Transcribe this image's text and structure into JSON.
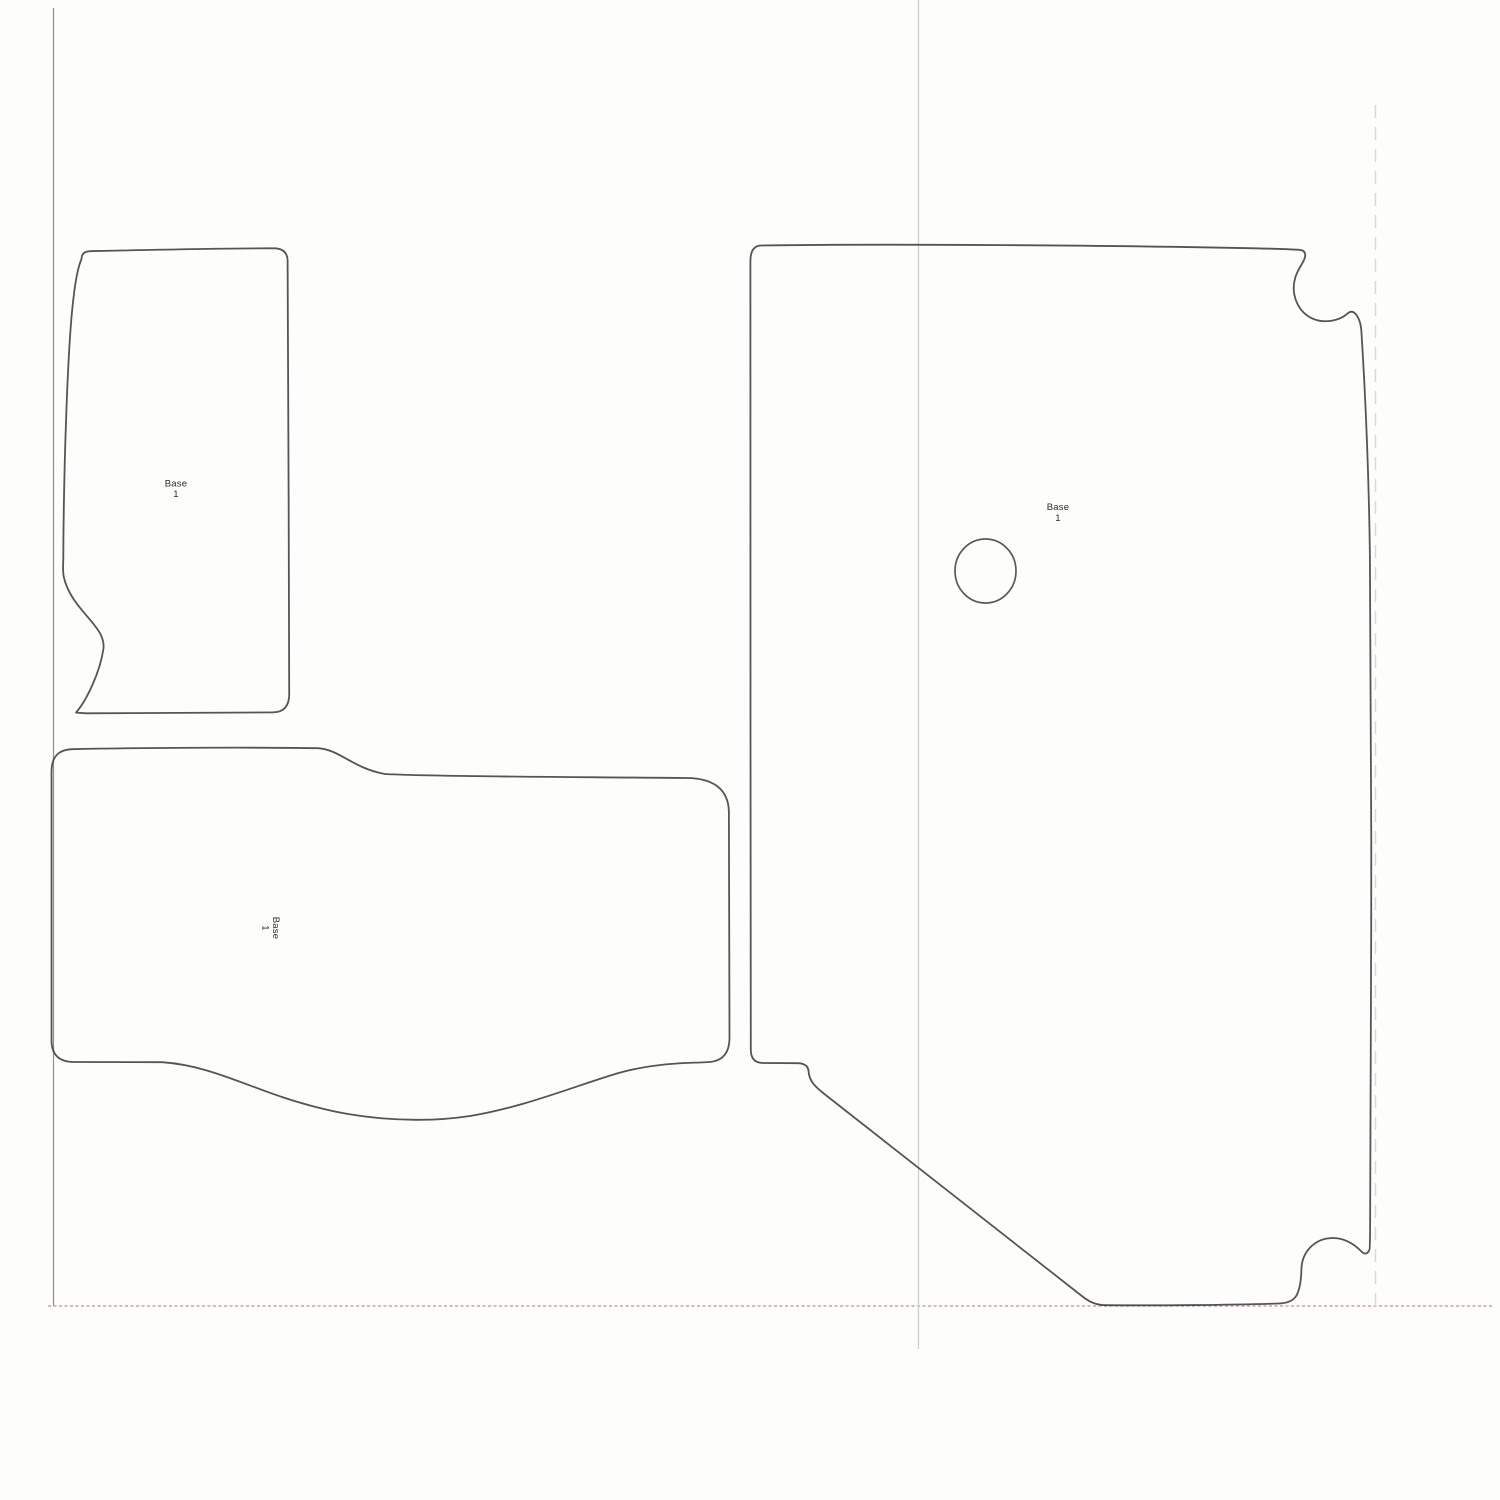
{
  "pieces": [
    {
      "id": "base-piece-upper-left",
      "label": {
        "line1": "Base",
        "line2": "1"
      }
    },
    {
      "id": "base-piece-lower-left",
      "label": {
        "line1": "Base",
        "line2": "1"
      }
    },
    {
      "id": "base-piece-right",
      "label": {
        "line1": "Base",
        "line2": "1"
      }
    }
  ],
  "colors": {
    "background": "#fdfdfc",
    "outline": "#3d3d3d",
    "label_text": "#2b2b2b",
    "page_border": "#8f8f8f",
    "bottom_margin": "#c18e9d",
    "vertical_guide": "#cdcdcd",
    "dashed_guide": "#d9d9d9"
  }
}
